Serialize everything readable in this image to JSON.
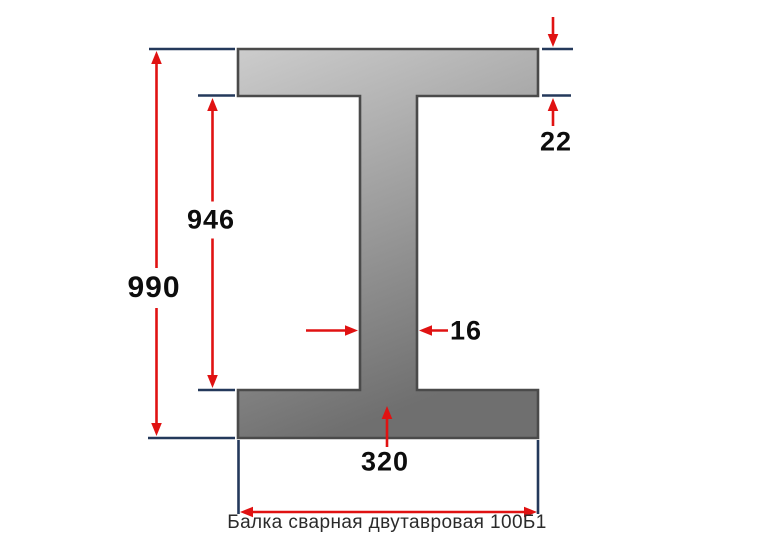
{
  "diagram": {
    "caption": "Балка сварная двутавровая 100Б1",
    "shape": "I-beam cross-section",
    "labels": {
      "total_height": "990",
      "web_height": "946",
      "flange_thickness": "22",
      "web_thickness": "16",
      "flange_width": "320"
    },
    "colors": {
      "dimension_arrow_red": "#e01212",
      "extension_line_blue": "#24395b",
      "beam_outline_gray": "#4a4a4a",
      "beam_fill_light": "#cccccc",
      "beam_fill_dark": "#6f6f6f",
      "background": "#ffffff"
    }
  }
}
